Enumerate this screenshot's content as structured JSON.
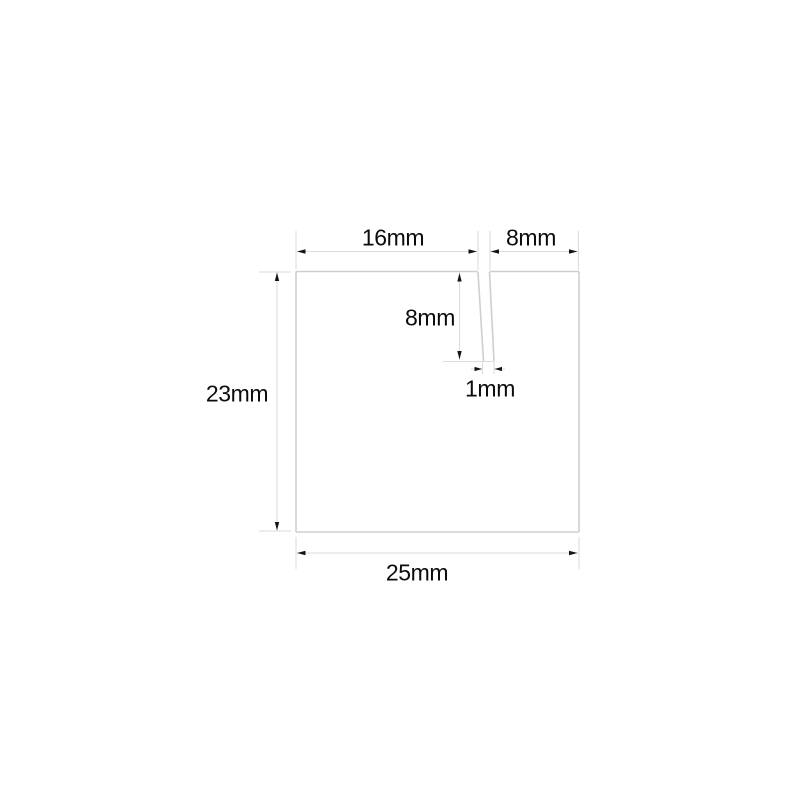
{
  "diagram": {
    "background_color": "#ffffff",
    "shape_line_color": "#ccd0d0",
    "dim_line_color": "#dadddd",
    "arrow_color": "#141414",
    "text_color": "#0c0c0c",
    "labels": {
      "top_width": "16mm",
      "top_right_width": "8mm",
      "slot_depth": "8mm",
      "slot_width": "1mm",
      "left_height": "23mm",
      "bottom_width": "25mm"
    }
  }
}
